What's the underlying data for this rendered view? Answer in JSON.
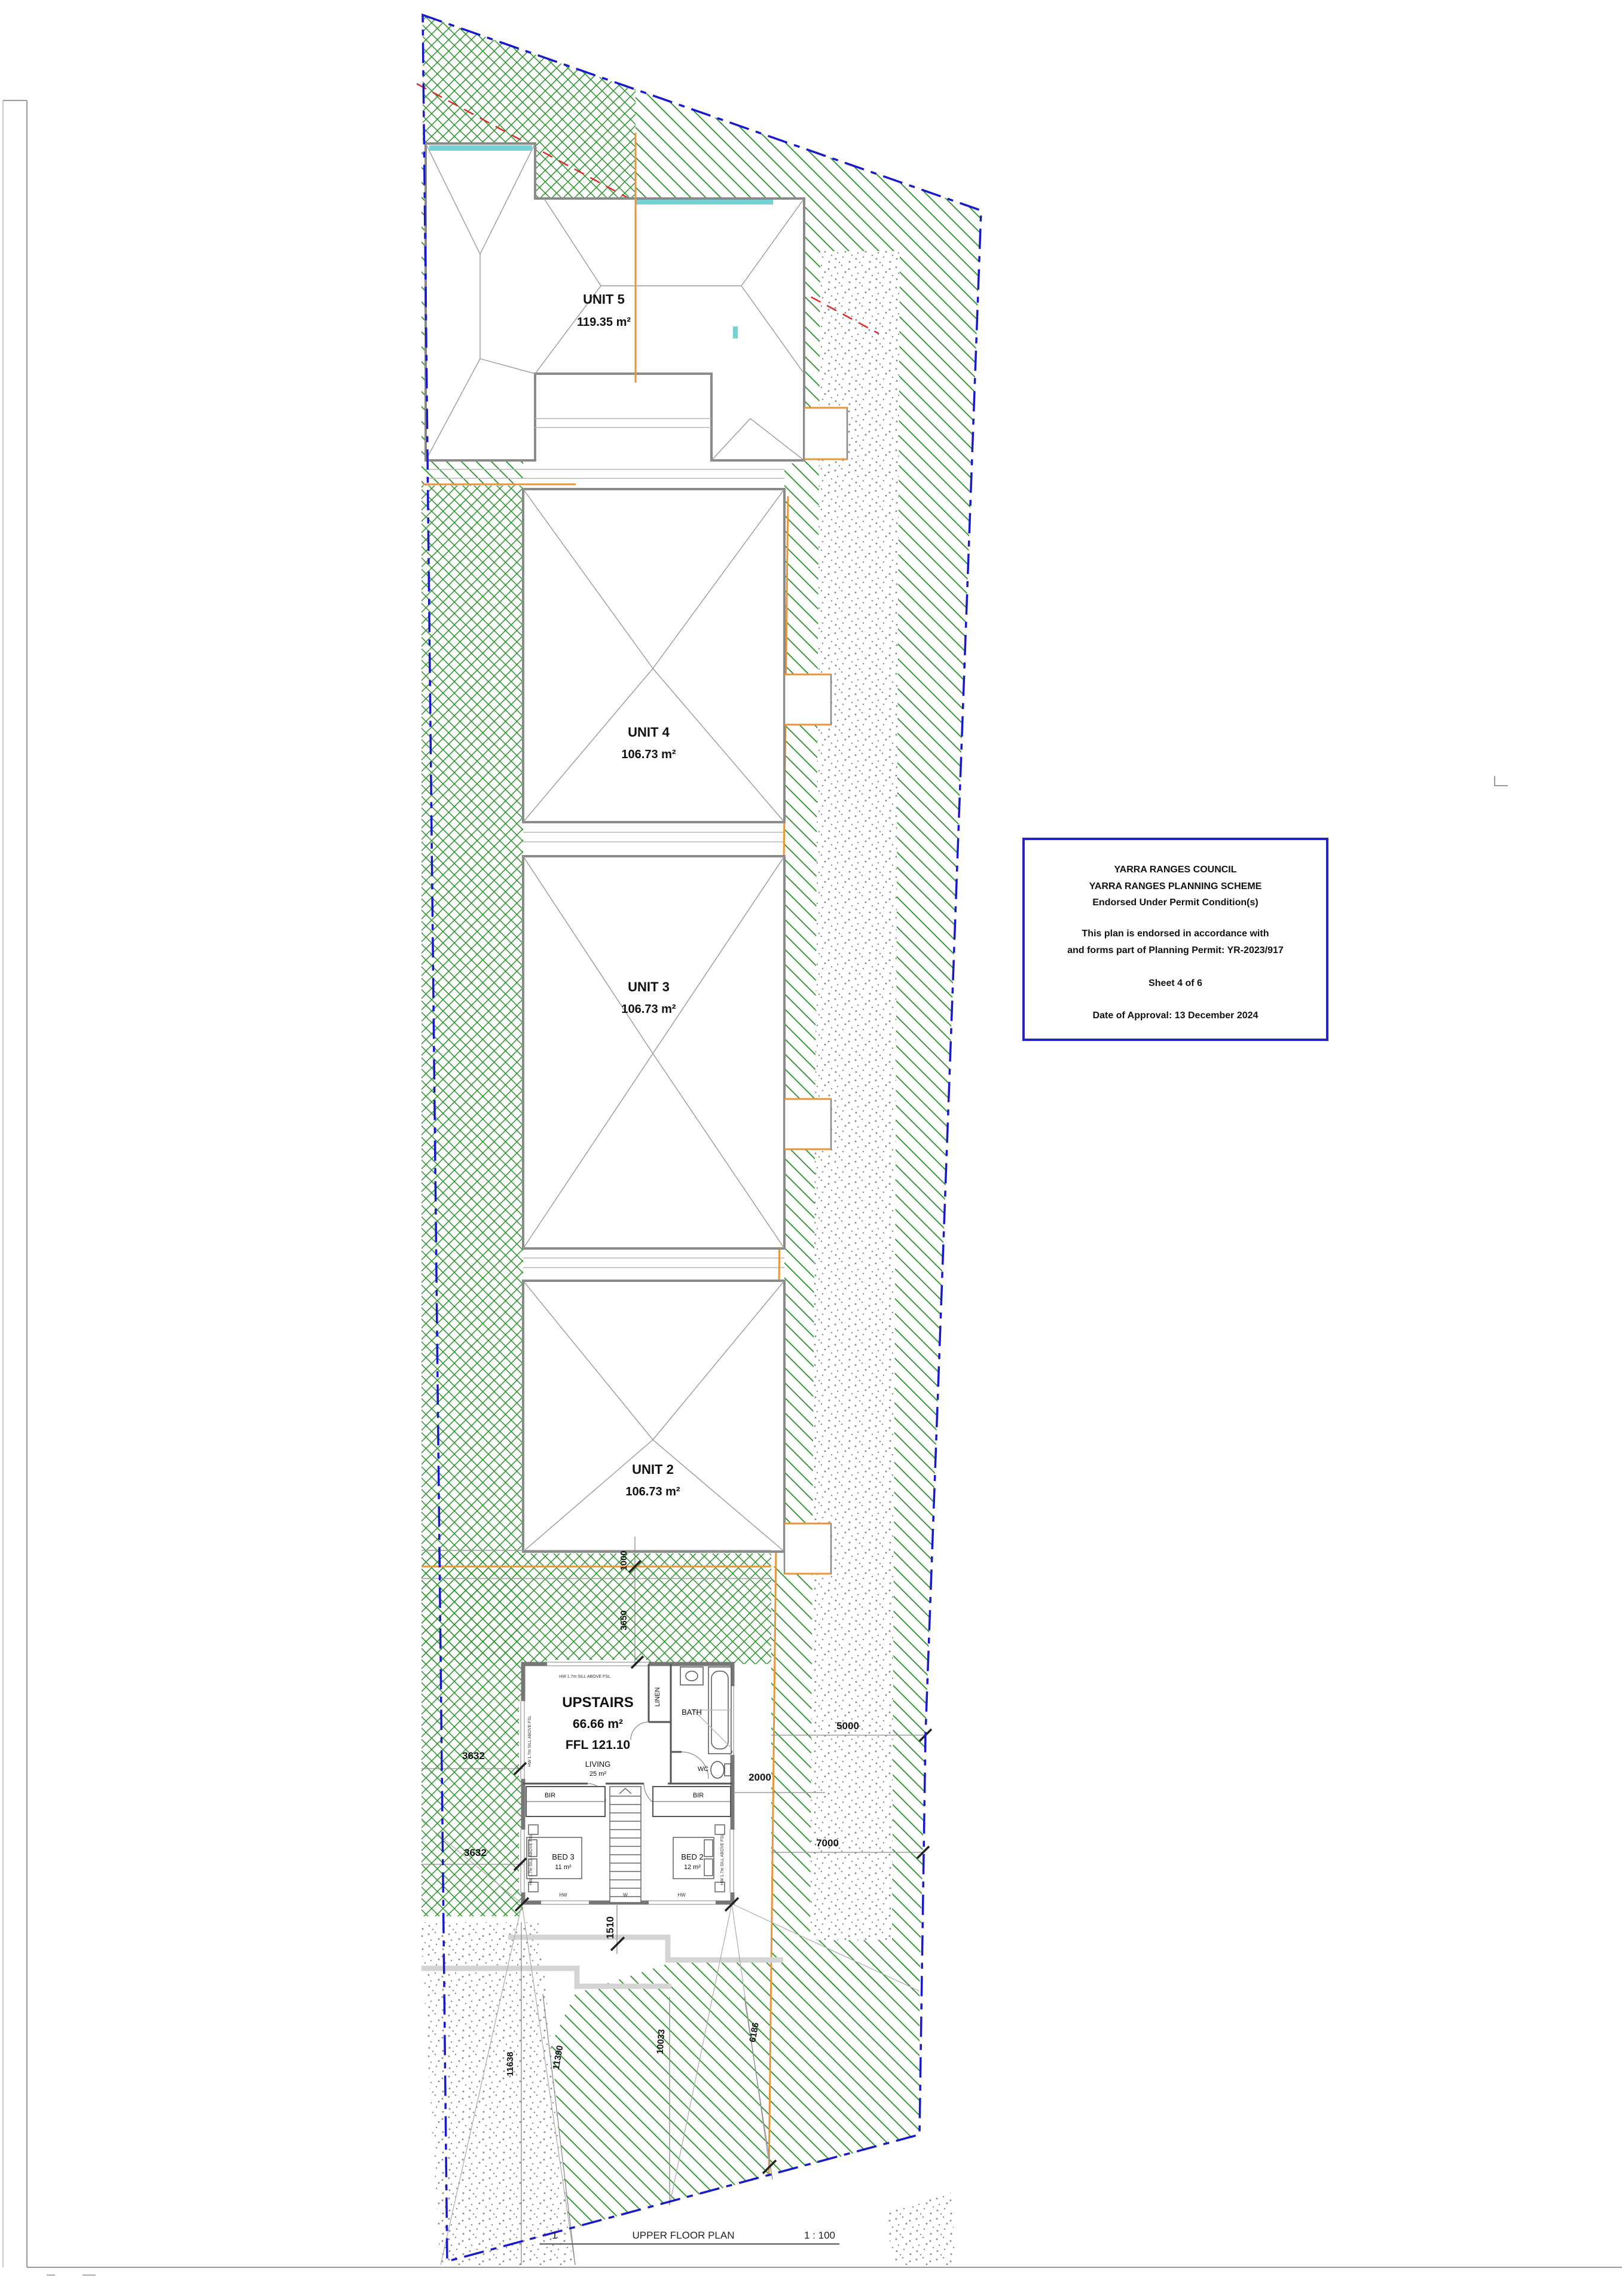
{
  "page": {
    "title_number": "1",
    "title": "UPPER FLOOR PLAN",
    "scale": "1 : 100"
  },
  "stamp": {
    "line1": "YARRA RANGES COUNCIL",
    "line2": "YARRA RANGES PLANNING SCHEME",
    "line3": "Endorsed Under Permit Condition(s)",
    "line4": "This plan is endorsed in accordance with",
    "line5": "and forms part of Planning Permit: YR-2023/917",
    "line6": "Sheet 4 of 6",
    "line7": "Date of Approval: 13 December 2024"
  },
  "units": [
    {
      "name": "UNIT 5",
      "area": "119.35 m²"
    },
    {
      "name": "UNIT 4",
      "area": "106.73 m²"
    },
    {
      "name": "UNIT 3",
      "area": "106.73 m²"
    },
    {
      "name": "UNIT 2",
      "area": "106.73 m²"
    }
  ],
  "floor_plan": {
    "title": "UPSTAIRS",
    "area": "66.66 m²",
    "ffl": "FFL 121.10",
    "living": "LIVING",
    "living_area": "25 m²",
    "rooms": {
      "linen": "LINEN",
      "bath": "BATH",
      "wc": "WC",
      "bir_left": "BIR",
      "bir_right": "BIR",
      "bed3": "BED 3",
      "bed3_area": "11 m²",
      "bed2": "BED 2",
      "bed2_area": "12 m²"
    },
    "notes": {
      "sill_top": "HW 1.7m SILL ABOVE FSL",
      "sill_left": "HW 1.7m SILL ABOVE FSL",
      "sill_bed_left": "HW 1.7m SILL ABOVE FSL",
      "sill_bed_right": "HW 1.7m SILL ABOVE FSL",
      "hw_left": "HW",
      "w_mid": "W",
      "hw_right": "HW"
    }
  },
  "dimensions": {
    "right_top": "5000",
    "right_mid": "7000",
    "right_small": "2000",
    "vert_1": "1000",
    "vert_2": "3650",
    "left_1": "3632",
    "left_2": "3632",
    "stair": "1510",
    "bottom_1": "11638",
    "bottom_2": "11390",
    "bottom_3": "10033",
    "bottom_4": "6186"
  },
  "colors": {
    "boundary_blue": "#1818cc",
    "stamp_blue": "#2323c8",
    "hatch_green": "#259325",
    "fence_orange": "#e8963c",
    "easement_red": "#d92b2b",
    "wall_gray": "#777777",
    "roof_gray": "#9a9a9a",
    "skylight_cyan": "#74d2d4"
  }
}
